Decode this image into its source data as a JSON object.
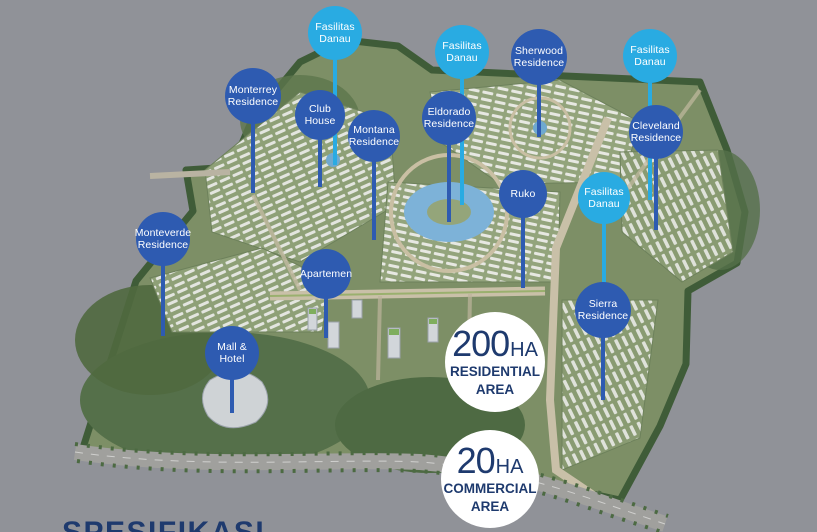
{
  "page": {
    "background_color": "#909298"
  },
  "colors": {
    "facility_pin": "#29abe2",
    "residence_pin": "#2e5bb1",
    "pin_text": "#ffffff",
    "stat_circle_bg": "#ffffff",
    "stat_text": "#1e3a6e",
    "heading_text": "#1e3a6e"
  },
  "pins": [
    {
      "id": "fasilitas-danau-1",
      "lines": [
        "Fasilitas",
        "Danau"
      ],
      "type": "facility",
      "x": 335,
      "y": 33,
      "r": 27,
      "stem_end": 165
    },
    {
      "id": "monterrey-residence",
      "lines": [
        "Monterrey",
        "Residence"
      ],
      "type": "residence",
      "x": 253,
      "y": 96,
      "r": 28,
      "stem_end": 193
    },
    {
      "id": "club-house",
      "lines": [
        "Club",
        "House"
      ],
      "type": "residence",
      "x": 320,
      "y": 115,
      "r": 25,
      "stem_end": 187
    },
    {
      "id": "montana-residence",
      "lines": [
        "Montana",
        "Residence"
      ],
      "type": "residence",
      "x": 374,
      "y": 136,
      "r": 26,
      "stem_end": 240
    },
    {
      "id": "fasilitas-danau-2",
      "lines": [
        "Fasilitas",
        "Danau"
      ],
      "type": "facility",
      "x": 462,
      "y": 52,
      "r": 27,
      "stem_end": 205
    },
    {
      "id": "sherwood-residence",
      "lines": [
        "Sherwood",
        "Residence"
      ],
      "type": "residence",
      "x": 539,
      "y": 57,
      "r": 28,
      "stem_end": 137
    },
    {
      "id": "fasilitas-danau-3",
      "lines": [
        "Fasilitas",
        "Danau"
      ],
      "type": "facility",
      "x": 650,
      "y": 56,
      "r": 27,
      "stem_end": 200
    },
    {
      "id": "eldorado-residence",
      "lines": [
        "Eldorado",
        "Residence"
      ],
      "type": "residence",
      "x": 449,
      "y": 118,
      "r": 27,
      "stem_end": 222
    },
    {
      "id": "cleveland-residence",
      "lines": [
        "Cleveland",
        "Residence"
      ],
      "type": "residence",
      "x": 656,
      "y": 132,
      "r": 27,
      "stem_end": 230
    },
    {
      "id": "ruko",
      "lines": [
        "Ruko"
      ],
      "type": "residence",
      "x": 523,
      "y": 194,
      "r": 24,
      "stem_end": 288
    },
    {
      "id": "fasilitas-danau-4",
      "lines": [
        "Fasilitas",
        "Danau"
      ],
      "type": "facility",
      "x": 604,
      "y": 198,
      "r": 26,
      "stem_end": 290
    },
    {
      "id": "monteverde-residence",
      "lines": [
        "Monteverde",
        "Residence"
      ],
      "type": "residence",
      "x": 163,
      "y": 239,
      "r": 27,
      "stem_end": 336
    },
    {
      "id": "apartemen",
      "lines": [
        "Apartemen"
      ],
      "type": "residence",
      "x": 326,
      "y": 274,
      "r": 25,
      "stem_end": 338
    },
    {
      "id": "sierra-residence",
      "lines": [
        "Sierra",
        "Residence"
      ],
      "type": "residence",
      "x": 603,
      "y": 310,
      "r": 28,
      "stem_end": 400
    },
    {
      "id": "mall-hotel",
      "lines": [
        "Mall &",
        "Hotel"
      ],
      "type": "residence",
      "x": 232,
      "y": 353,
      "r": 27,
      "stem_end": 413
    }
  ],
  "area_stats": [
    {
      "id": "residential-area",
      "value": "200",
      "unit": "HA",
      "label_lines": [
        "RESIDENTIAL",
        "AREA"
      ],
      "x": 495,
      "y": 362,
      "r": 50
    },
    {
      "id": "commercial-area",
      "value": "20",
      "unit": "HA",
      "label_lines": [
        "COMMERCIAL",
        "AREA"
      ],
      "x": 490,
      "y": 479,
      "r": 49
    }
  ],
  "bottom_heading": {
    "text": "SPESIFIKASI"
  }
}
